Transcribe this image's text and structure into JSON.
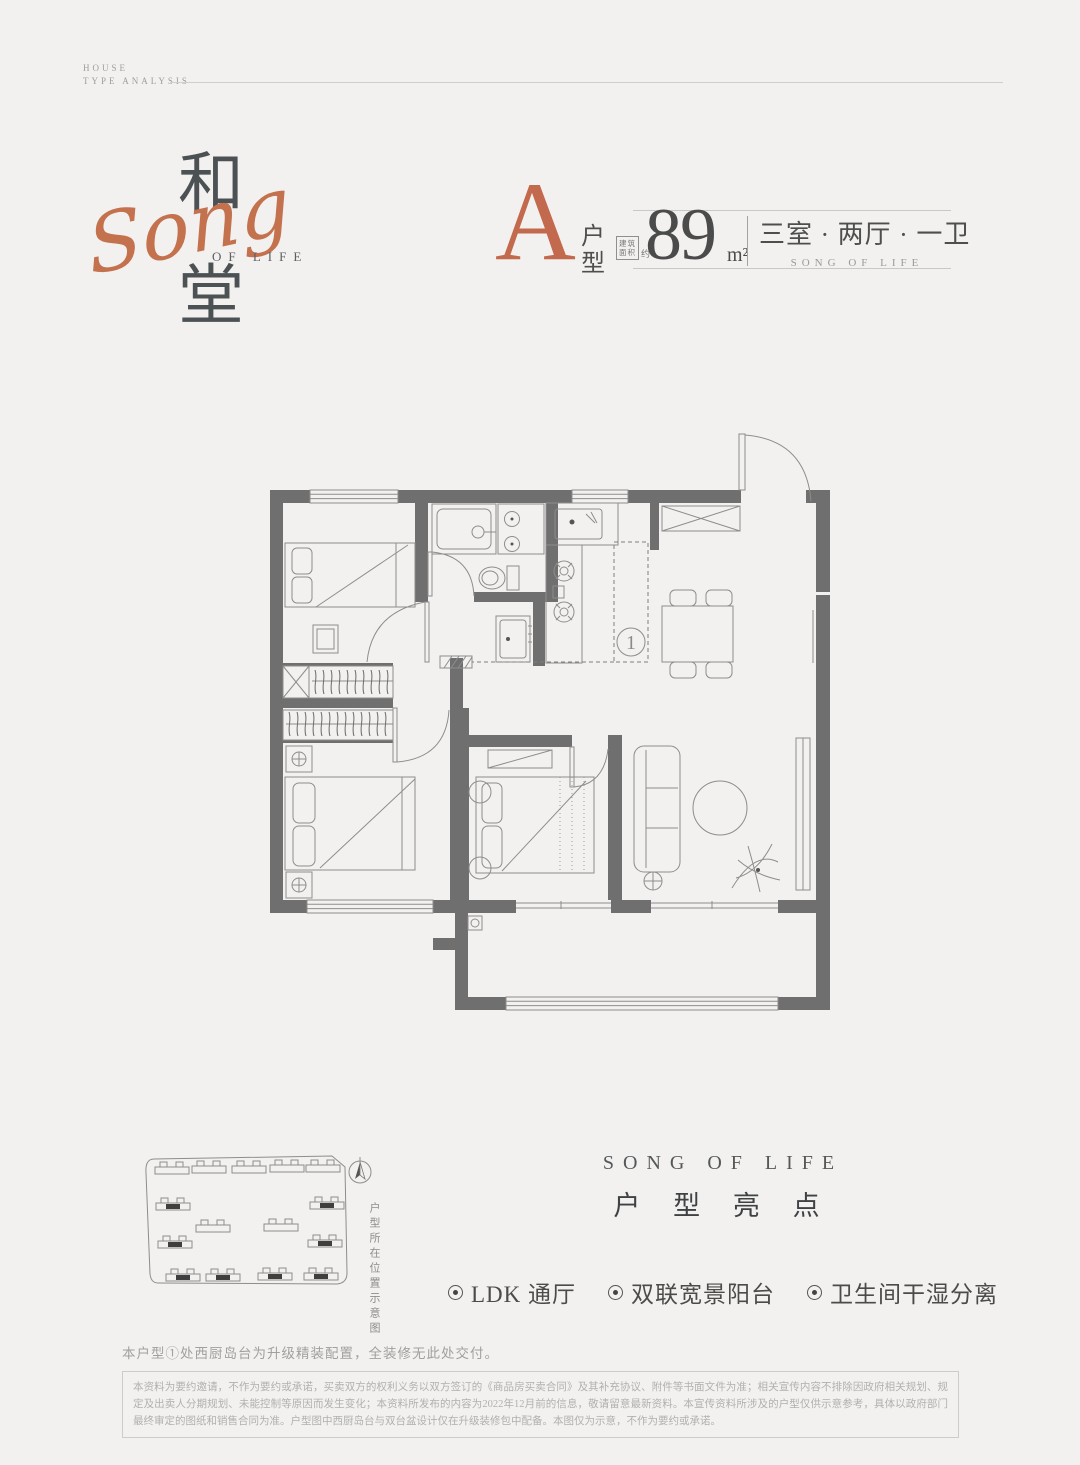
{
  "colors": {
    "background": "#F2F1EF",
    "accent": "#C4704E",
    "wall": "#6F6F6F"
  },
  "eyebrow": {
    "line1": "HOUSE",
    "line2": "TYPE ANALYSIS"
  },
  "logo": {
    "char_top": "和",
    "script": "Song",
    "of_life": "OF LIFE",
    "char_bottom": "堂"
  },
  "headline": {
    "unit_letter": "A",
    "unit_label_chars": [
      "户",
      "型"
    ],
    "area_stamp": {
      "line1": "建筑",
      "line2": "面积",
      "suffix": "约"
    },
    "area_value": "89",
    "area_unit": "m²",
    "layout_text": "三室 · 两厅 · 一卫",
    "layout_subtext": "SONG OF LIFE"
  },
  "floorplan": {
    "callout": "1"
  },
  "siteplan": {
    "caption": "户型所在位置示意图"
  },
  "highlights": {
    "eyebrow": "SONG OF LIFE",
    "title": "户 型 亮 点",
    "items": [
      "LDK 通厅",
      "双联宽景阳台",
      "卫生间干湿分离"
    ]
  },
  "footer": {
    "note": "本户型①处西厨岛台为升级精装配置，全装修无此处交付。",
    "legal": "本资料为要约邀请，不作为要约或承诺，买卖双方的权利义务以双方签订的《商品房买卖合同》及其补充协议、附件等书面文件为准；相关宣传内容不排除因政府相关规划、规定及出卖人分期规划、未能控制等原因而发生变化；本资料所发布的内容为2022年12月前的信息，敬请留意最新资料。本宣传资料所涉及的户型仅供示意参考，具体以政府部门最终审定的图纸和销售合同为准。户型图中西厨岛台与双台盆设计仅在升级装修包中配备。本图仅为示意，不作为要约或承诺。"
  }
}
